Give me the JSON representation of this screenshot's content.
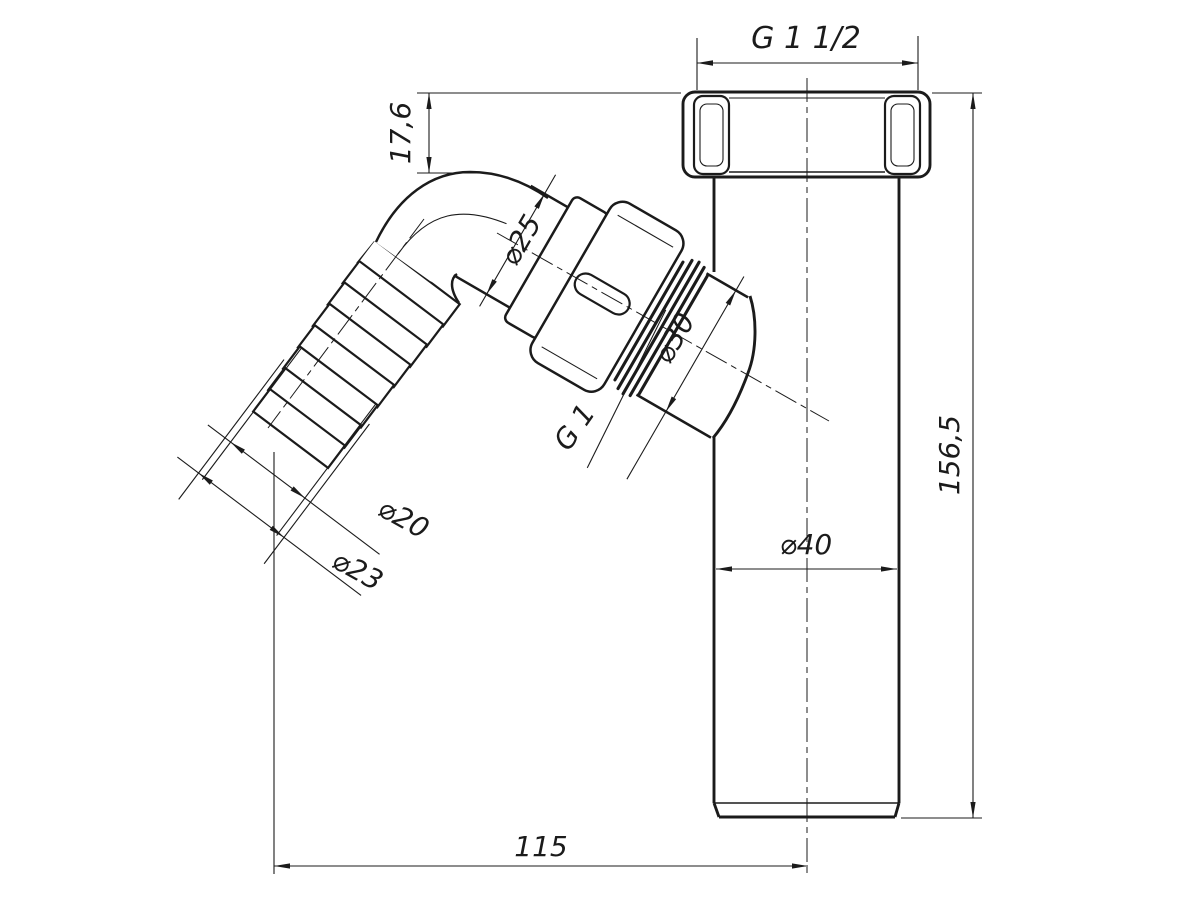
{
  "drawing": {
    "kind": "technical-dimension-drawing",
    "subject": "bottle-trap drain tube with angled barbed side inlet",
    "colors": {
      "ink": "#1b1b1b",
      "paper": "#ffffff"
    }
  },
  "dimensions": {
    "thread_top": "G 1 1/2",
    "nut_height": "17,6",
    "branch_pipe_dia": "⌀25",
    "branch_port_dia": "⌀30",
    "branch_thread": "G 1",
    "barb_groove_dia": "⌀20",
    "barb_crest_dia": "⌀23",
    "tube_dia": "⌀40",
    "total_height": "156,5",
    "horizontal_length": "115"
  }
}
